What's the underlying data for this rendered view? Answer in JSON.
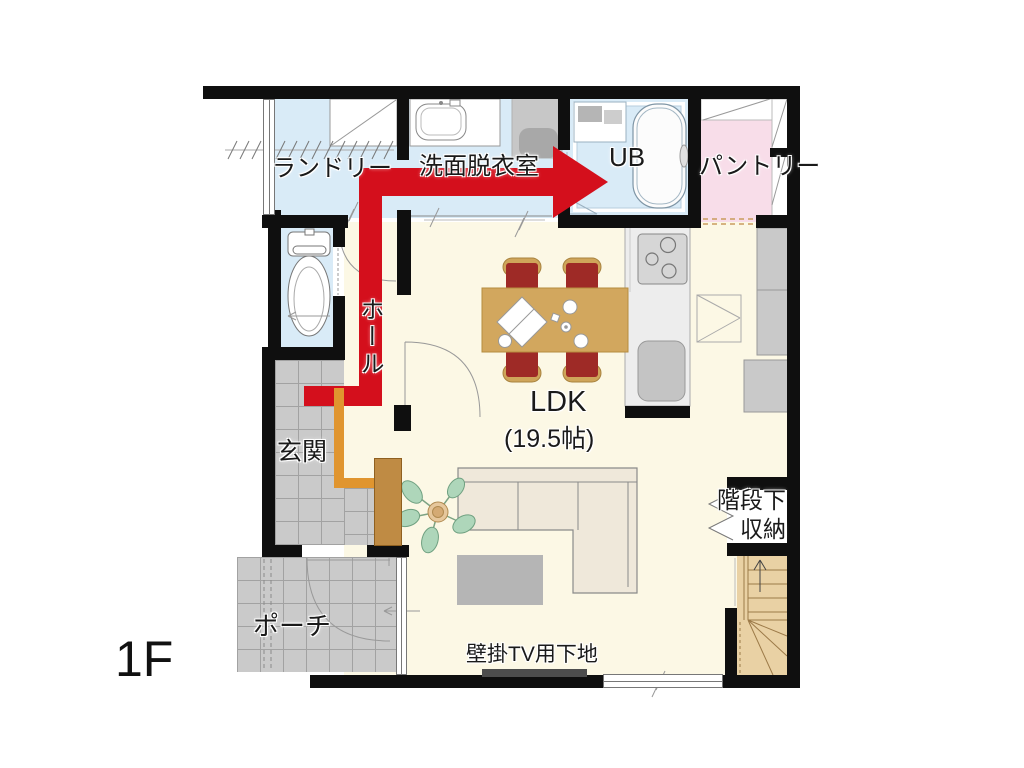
{
  "floor_label": "1F",
  "rooms": {
    "laundry": "ランドリー",
    "washroom": "洗面脱衣室",
    "unit_bath": "UB",
    "pantry": "パントリー",
    "hall": "ホール",
    "entrance": "玄関",
    "porch": "ポーチ",
    "ldk_name": "LDK",
    "ldk_size": "(19.5帖)",
    "stair_storage_line1": "階段下",
    "stair_storage_line2": "収納",
    "tv_wall_note": "壁掛TV用下地"
  },
  "colors": {
    "wall": "#0f0f0f",
    "wet_room_floor": "#d9ebf7",
    "ldk_floor": "#fcf8e5",
    "pantry_floor": "#f8dde9",
    "tile_floor": "#cacaca",
    "stairs_floor": "#e9d1a4",
    "flow_arrow_red": "#d40f1c",
    "step_orange": "#e0952f",
    "table_wood": "#d2a75e",
    "chair_red": "#9e2a26",
    "cabinet_brown": "#bf8b44"
  }
}
